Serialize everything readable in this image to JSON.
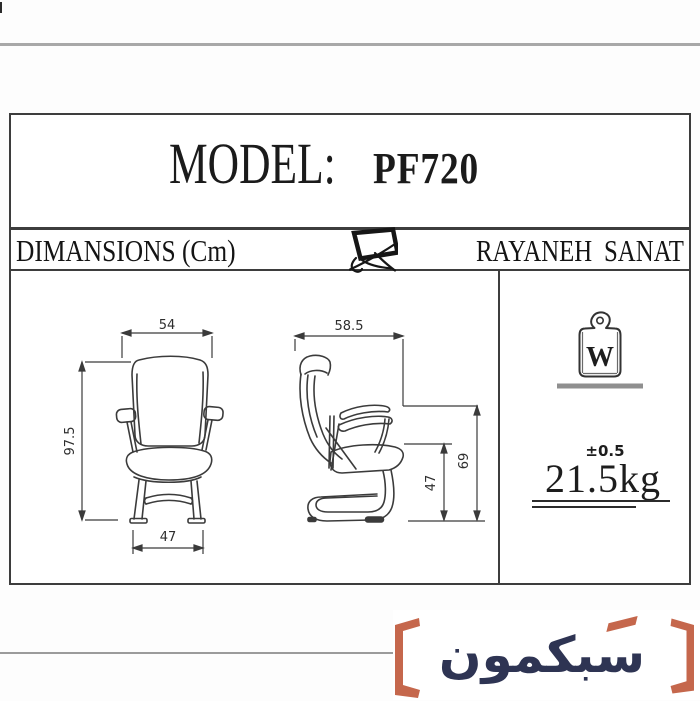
{
  "sheet": {
    "model_label": "MODEL:",
    "model_value": "PF720",
    "dimensions_label": "DIMANSIONS (Cm)",
    "brand_name": "RAYANEH SANAT"
  },
  "front_view": {
    "overall_width_cm": "54",
    "overall_height_cm": "97.5",
    "base_width_cm": "47"
  },
  "side_view": {
    "overall_depth_cm": "58.5",
    "seat_height_cm": "47",
    "armrest_height_cm": "69"
  },
  "weight": {
    "symbol": "W",
    "tolerance": "±0.5",
    "value": "21.5kg"
  },
  "watermark": {
    "brand_text": "سبکمون"
  },
  "colors": {
    "accent_orange": "#c5674c",
    "brand_navy": "#2e3453",
    "rule_gray": "#a8a8a8",
    "drawing_ink": "#3b3b3b"
  }
}
